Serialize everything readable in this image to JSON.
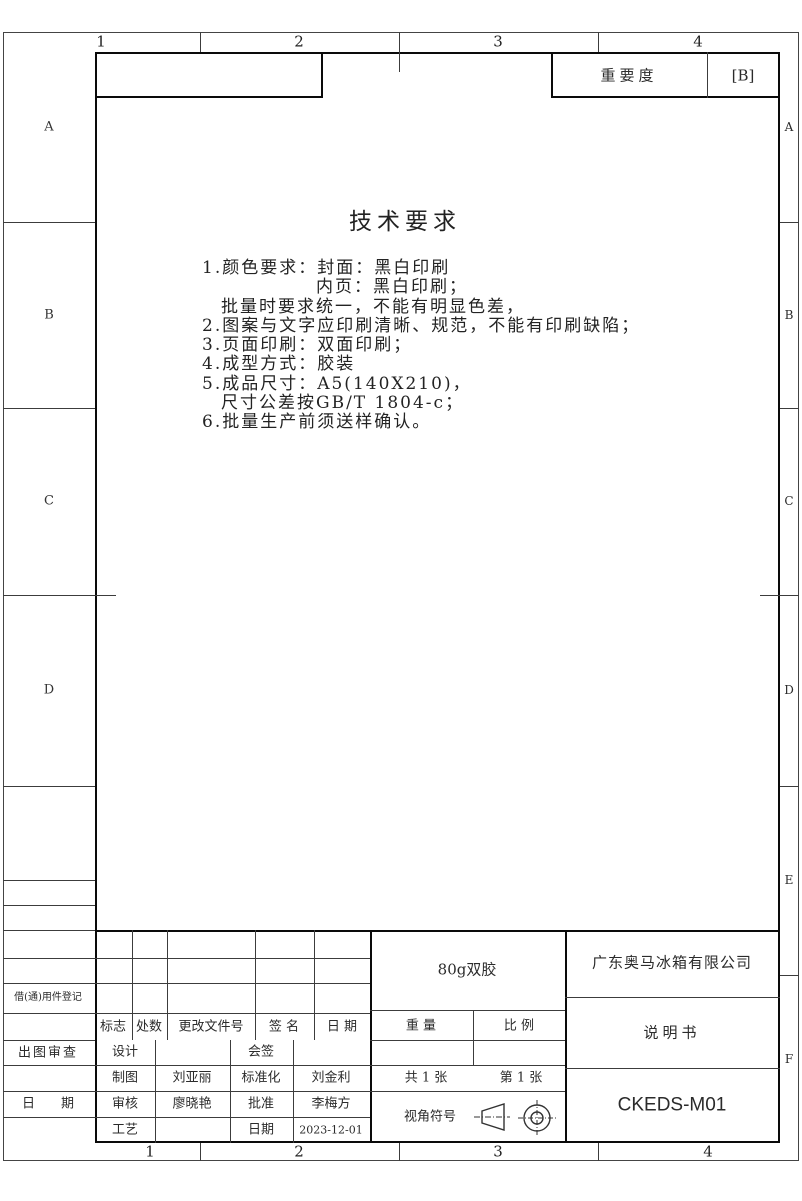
{
  "importance": {
    "label": "重要度",
    "value": "[B]"
  },
  "zones": {
    "top": [
      "1",
      "2",
      "3",
      "4"
    ],
    "bottom": [
      "1",
      "2",
      "3",
      "4"
    ],
    "left": [
      "A",
      "B",
      "C",
      "D"
    ],
    "right": [
      "A",
      "B",
      "C",
      "D",
      "E",
      "F"
    ]
  },
  "tech_requirements": {
    "title": "技术要求",
    "lines": [
      "1.颜色要求：封面：黑白印刷",
      "　　　　　　内页：黑白印刷；",
      "　批量时要求统一，不能有明显色差，",
      "2.图案与文字应印刷清晰、规范，不能有印刷缺陷；",
      "3.页面印刷：双面印刷；",
      "4.成型方式：胶装",
      "5.成品尺寸：A5(140X210)，",
      "　尺寸公差按GB/T 1804-c；",
      "6.批量生产前须送样确认。"
    ]
  },
  "left_panel": {
    "borrow_register": "借(通)用件登记",
    "drawing_review": "出图审查",
    "date": "日　　期"
  },
  "change_table": {
    "headers": [
      "标志",
      "处数",
      "更改文件号",
      "签 名",
      "日 期"
    ]
  },
  "approval_table": {
    "rows": [
      {
        "c1": "设计",
        "c2": "",
        "c3": "会签",
        "c4": ""
      },
      {
        "c1": "制图",
        "c2": "刘亚丽",
        "c3": "标准化",
        "c4": "刘金利"
      },
      {
        "c1": "审核",
        "c2": "廖晓艳",
        "c3": "批准",
        "c4": "李梅方"
      },
      {
        "c1": "工艺",
        "c2": "",
        "c3": "日期",
        "c4": "2023-12-01"
      }
    ]
  },
  "spec_block": {
    "material": "80g双胶",
    "weight_label": "重 量",
    "scale_label": "比 例",
    "sheet_total": "共 1 张",
    "sheet_no": "第 1 张",
    "view_symbol_label": "视角符号"
  },
  "title_block": {
    "company": "广东奥马冰箱有限公司",
    "doc_title": "说明书",
    "drawing_no": "CKEDS-M01"
  }
}
